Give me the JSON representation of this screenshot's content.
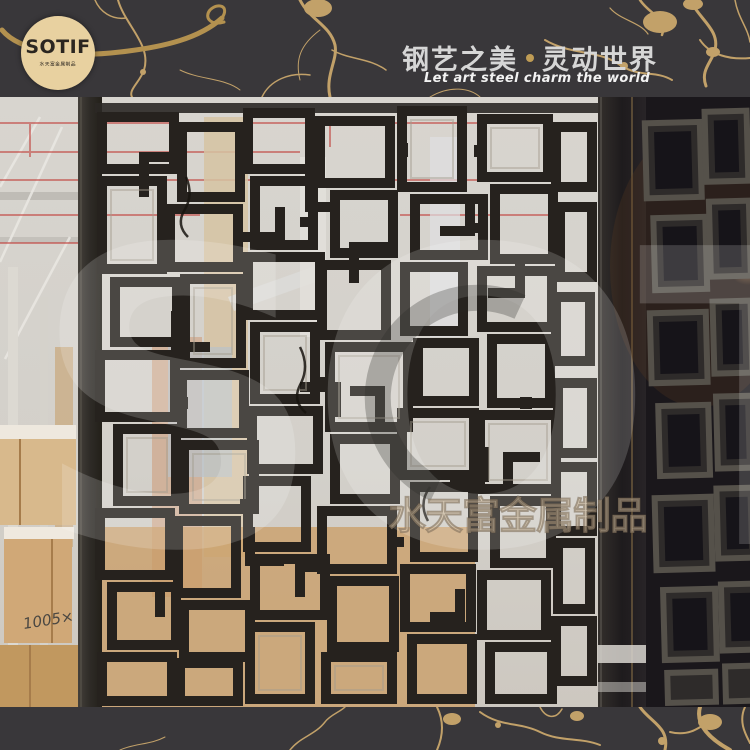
{
  "brand": {
    "logo_text": "SOTIF",
    "logo_subtext": "水天富金属制品",
    "logo_circle_color": "#e8d1a0",
    "logo_text_color": "#2b2620"
  },
  "header": {
    "slogan_cn_left": "钢艺之美",
    "slogan_cn_right": "灵动世界",
    "slogan_en": "Let art steel charm the world",
    "text_color": "#d6d6d6",
    "band_color": "#39373a",
    "vein_color": "#c2a169",
    "swoosh_color": "#b3914f",
    "divider_icon": "gold-dot"
  },
  "photo": {
    "watermark_logo": "SOTIF",
    "watermark_company": "水天富金属制品",
    "crate_marking": "1005×",
    "lattice_color": "#26221e",
    "background_color": "#d3d0ca",
    "right_panel_color": "#1a171b",
    "red_line_color": "#c13a35",
    "glow_color": "#ffd9a0"
  }
}
